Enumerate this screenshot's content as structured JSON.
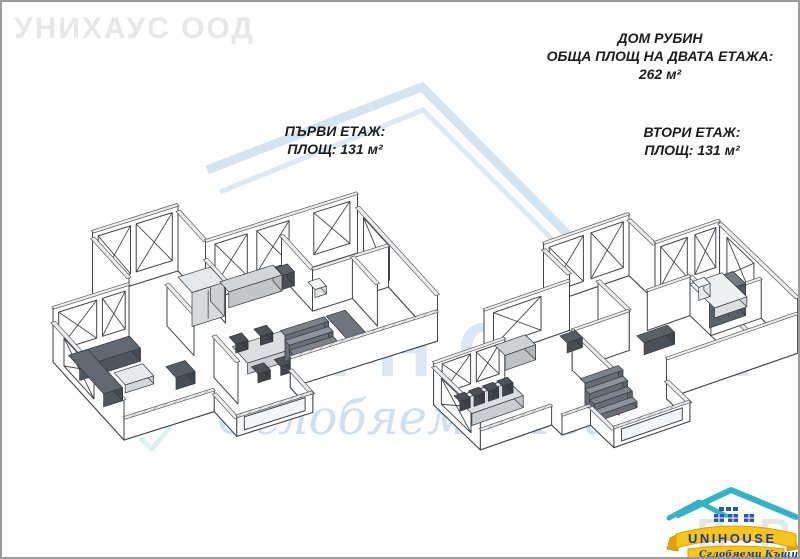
{
  "corner_watermark": "УНИХАУС ООД",
  "header": {
    "title": "ДОМ РУБИН",
    "subtitle": "ОБЩА ПЛОЩ НА ДВАТА ЕТАЖА:",
    "total_area": "262 м²"
  },
  "plans": {
    "first": {
      "name": "ПЪРВИ ЕТАЖ:",
      "area": "ПЛОЩ: 131 м²"
    },
    "second": {
      "name": "ВТОРИ ЕТАЖ:",
      "area": "ПЛОЩ: 131 м²"
    }
  },
  "center_watermark": {
    "brand": "UNIHOUSE",
    "tagline": "Сглобяеми Къщи",
    "house_icon": "house-outline-icon",
    "color": "#cfe2f0"
  },
  "logo": {
    "brand": "UNIHOUSE",
    "tagline": "Сглобяеми Къщи",
    "icon": "house-roof-icon",
    "wm_left": "B",
    "wm_right": "R",
    "colors": {
      "roof_teal": "#35b2c4",
      "banner_yellow": "#f6c41c",
      "banner_edge": "#d89d06",
      "text_blue": "#1c3e96",
      "window_blue": "#2a57a8"
    }
  }
}
